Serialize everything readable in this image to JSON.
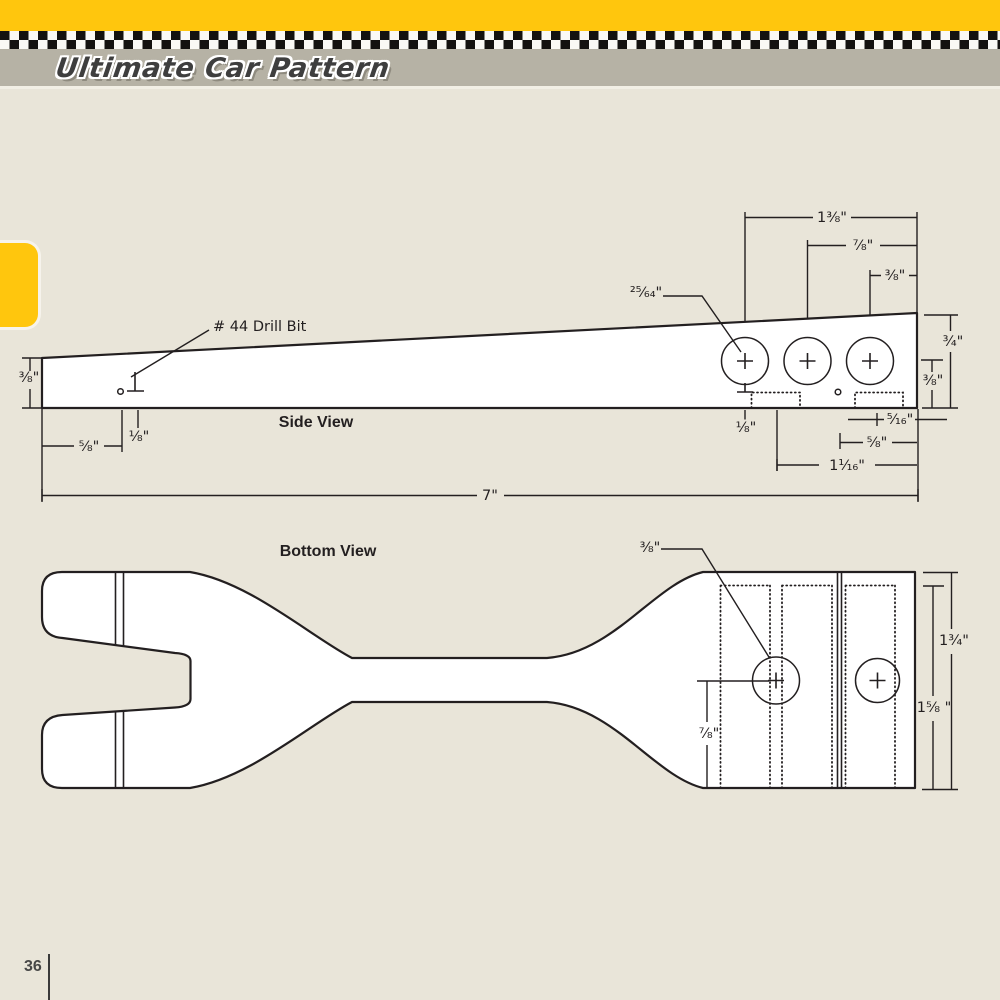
{
  "page": {
    "number": "36"
  },
  "header": {
    "title": "Ultimate Car Pattern",
    "band_yellow": "#ffc60d",
    "band_gray": "#b6b2a5",
    "checker_dark": "#141210",
    "checker_light": "#faf9f5"
  },
  "side_view": {
    "title": "Side View",
    "labels": {
      "drill_bit": "# 44 Drill Bit",
      "hole_diameter": "²⁵⁄₆₄\"",
      "left_height": "⅜\"",
      "top_span_wide": "1⅜\"",
      "top_span_mid": "⅞\"",
      "top_span_small": "⅜\"",
      "right_height": "¾\"",
      "right_lower_height": "⅜\"",
      "front_hole_inset": "⅝\"",
      "front_drill_depth": "⅛\"",
      "rear_drill_depth": "⅛\"",
      "rear_slot_inset": "⁵⁄₁₆\"",
      "rear_hole_inset": "⅝\"",
      "rear_span": "1¹⁄₁₆\"",
      "overall_length": "7\""
    }
  },
  "bottom_view": {
    "title": "Bottom View",
    "labels": {
      "hole_diameter": "⅜\"",
      "hole_from_rear": "⅞\"",
      "overall_width": "1¾\"",
      "inner_width": "1⅝ \""
    }
  }
}
